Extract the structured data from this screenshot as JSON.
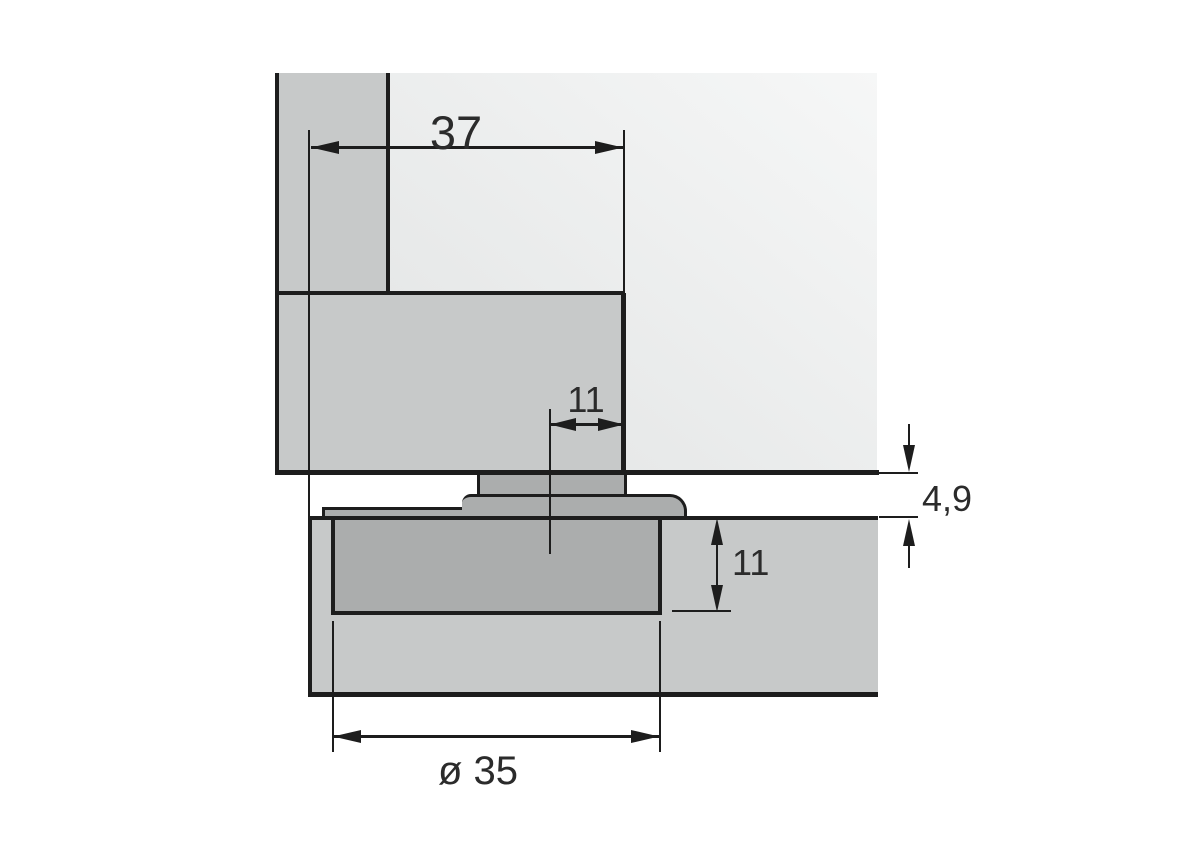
{
  "diagram": {
    "type": "hinge-cup-mounting-cross-section",
    "dimensions": {
      "top_width": "37",
      "arm_offset": "11",
      "panel_gap": "4,9",
      "cup_depth": "11",
      "cup_diameter": "ø 35"
    }
  },
  "colors": {
    "background": "#ffffff",
    "panel_gray": "#c7c9c9",
    "panel_light_1": "#f6f7f7",
    "panel_light_2": "#e2e4e4",
    "hardware_gray": "#abadad",
    "line": "#1d1d1d",
    "text": "#2b2b2b"
  }
}
